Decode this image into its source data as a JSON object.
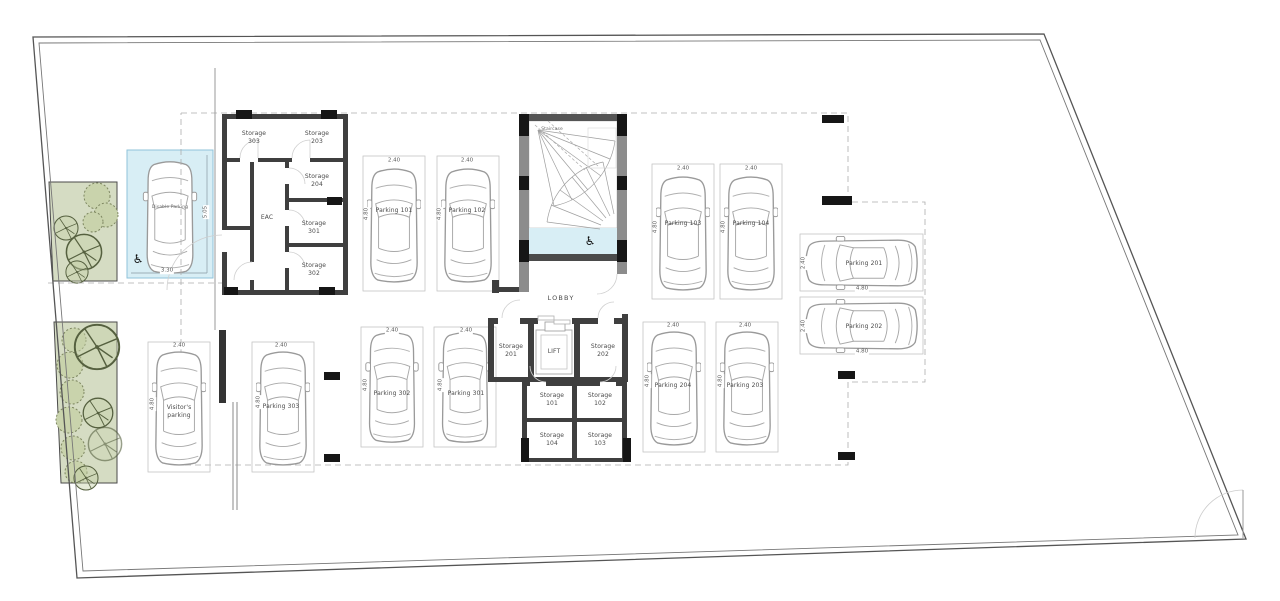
{
  "title": "Parking level floor plan",
  "rooms": {
    "storage_303": "Storage\n303",
    "storage_203": "Storage\n203",
    "storage_204": "Storage\n204",
    "storage_301": "Storage\n301",
    "storage_302": "Storage\n302",
    "eac": "EAC",
    "staircase": "Staircase",
    "lobby": "LOBBY",
    "lift": "LIFT",
    "storage_201": "Storage\n201",
    "storage_202": "Storage\n202",
    "storage_101": "Storage\n101",
    "storage_102": "Storage\n102",
    "storage_103": "Storage\n103",
    "storage_104": "Storage\n104"
  },
  "parking": {
    "p101": "Parking 101",
    "p102": "Parking 102",
    "p103": "Parking 103",
    "p104": "Parking 104",
    "p201": "Parking 201",
    "p202": "Parking 202",
    "p203": "Parking 203",
    "p204": "Parking 204",
    "p301": "Parking 301",
    "p302": "Parking 302",
    "p303": "Parking 303",
    "visitor": "Visitor's\nparking",
    "disabled": "Disable Parking"
  },
  "dims": {
    "w": "2.40",
    "l": "4.80",
    "dl": "5.05",
    "dw": "3.30"
  },
  "icons": {
    "wheelchair": "♿"
  },
  "colors": {
    "landscaping": "#d5dcc3",
    "disabled_bay": "#d8eef5",
    "wall": "#3f3f3f",
    "column": "#161616"
  }
}
